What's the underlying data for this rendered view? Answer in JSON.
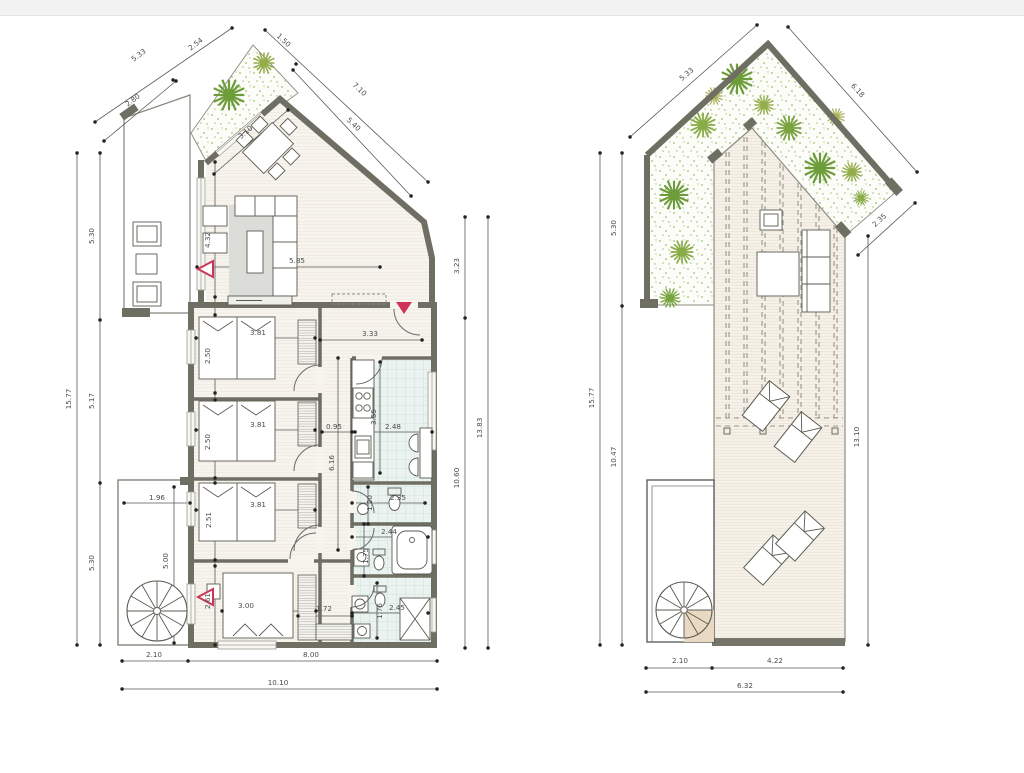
{
  "colors": {
    "wall_gray": "#6e6e63",
    "dimension_text": "#4c4c4c",
    "accent_red": "#cf3357",
    "garden_green": "#6d9c3a",
    "tile_teal": "#c6ded8",
    "wood_floor": "#f7f4ee",
    "terrace_tile": "#e6d4bc",
    "rug_gray": "#dcdcd8",
    "top_bar": "#f2f2f3"
  },
  "plans": {
    "left": {
      "name": "ground-floor-plan",
      "labels": [
        {
          "t": "5.33",
          "x": 140,
          "y": 57,
          "r": -37
        },
        {
          "t": "2.54",
          "x": 197,
          "y": 46,
          "r": -37
        },
        {
          "t": "2.80",
          "x": 134,
          "y": 102,
          "r": -37
        },
        {
          "t": "1.50",
          "x": 282,
          "y": 42,
          "r": 43
        },
        {
          "t": "7.10",
          "x": 358,
          "y": 91,
          "r": 43
        },
        {
          "t": "5.40",
          "x": 352,
          "y": 126,
          "r": 43
        },
        {
          "t": "15.77",
          "x": 71,
          "y": 399,
          "r": -90
        },
        {
          "t": "5.30",
          "x": 94,
          "y": 236,
          "r": -90
        },
        {
          "t": "5.17",
          "x": 94,
          "y": 401,
          "r": -90
        },
        {
          "t": "5.30",
          "x": 94,
          "y": 563,
          "r": -90
        },
        {
          "t": "3.23",
          "x": 459,
          "y": 266,
          "r": -90
        },
        {
          "t": "10.60",
          "x": 459,
          "y": 478,
          "r": -90
        },
        {
          "t": "13.83",
          "x": 482,
          "y": 428,
          "r": -90
        },
        {
          "t": "2.10",
          "x": 154,
          "y": 657,
          "r": 0
        },
        {
          "t": "8.00",
          "x": 311,
          "y": 657,
          "r": 0
        },
        {
          "t": "10.10",
          "x": 278,
          "y": 685,
          "r": 0
        },
        {
          "t": "5.85",
          "x": 297,
          "y": 263,
          "r": 0
        },
        {
          "t": "4.32",
          "x": 210,
          "y": 240,
          "r": -90
        },
        {
          "t": "3.10",
          "x": 247,
          "y": 134,
          "r": -40
        },
        {
          "t": "3.81",
          "x": 258,
          "y": 335,
          "r": 0
        },
        {
          "t": "2.50",
          "x": 210,
          "y": 356,
          "r": -90
        },
        {
          "t": "3.81",
          "x": 258,
          "y": 427,
          "r": 0
        },
        {
          "t": "2.50",
          "x": 210,
          "y": 442,
          "r": -90
        },
        {
          "t": "3.81",
          "x": 258,
          "y": 507,
          "r": 0
        },
        {
          "t": "2.51",
          "x": 211,
          "y": 520,
          "r": -90
        },
        {
          "t": "3.00",
          "x": 246,
          "y": 608,
          "r": 0
        },
        {
          "t": "2.61",
          "x": 210,
          "y": 601,
          "r": -90
        },
        {
          "t": "3.33",
          "x": 370,
          "y": 336,
          "r": 0
        },
        {
          "t": "0.95",
          "x": 334,
          "y": 429,
          "r": 0
        },
        {
          "t": "6.16",
          "x": 334,
          "y": 463,
          "r": -90
        },
        {
          "t": "2.48",
          "x": 393,
          "y": 429,
          "r": 0
        },
        {
          "t": "3.55",
          "x": 376,
          "y": 417,
          "r": -90
        },
        {
          "t": "1.20",
          "x": 372,
          "y": 503,
          "r": -90
        },
        {
          "t": "2.35",
          "x": 398,
          "y": 500,
          "r": 0
        },
        {
          "t": "2.44",
          "x": 389,
          "y": 534,
          "r": 0
        },
        {
          "t": "1.75",
          "x": 368,
          "y": 556,
          "r": -90
        },
        {
          "t": "2.45",
          "x": 397,
          "y": 610,
          "r": 0
        },
        {
          "t": "1.76",
          "x": 382,
          "y": 611,
          "r": -90
        },
        {
          "t": "1.72",
          "x": 324,
          "y": 611,
          "r": 0
        },
        {
          "t": "1.96",
          "x": 157,
          "y": 500,
          "r": 0
        },
        {
          "t": "5.00",
          "x": 168,
          "y": 561,
          "r": -90
        }
      ]
    },
    "right": {
      "name": "roof-terrace-plan",
      "labels": [
        {
          "t": "5.33",
          "x": 688,
          "y": 76,
          "r": -40
        },
        {
          "t": "6.18",
          "x": 856,
          "y": 92,
          "r": 47
        },
        {
          "t": "2.35",
          "x": 881,
          "y": 222,
          "r": -42
        },
        {
          "t": "15.77",
          "x": 594,
          "y": 398,
          "r": -90
        },
        {
          "t": "5.30",
          "x": 616,
          "y": 228,
          "r": -90
        },
        {
          "t": "10.47",
          "x": 616,
          "y": 457,
          "r": -90
        },
        {
          "t": "13.10",
          "x": 859,
          "y": 437,
          "r": -90
        },
        {
          "t": "2.10",
          "x": 680,
          "y": 663,
          "r": 0
        },
        {
          "t": "4.22",
          "x": 775,
          "y": 663,
          "r": 0
        },
        {
          "t": "6.32",
          "x": 745,
          "y": 688,
          "r": 0
        }
      ]
    }
  }
}
